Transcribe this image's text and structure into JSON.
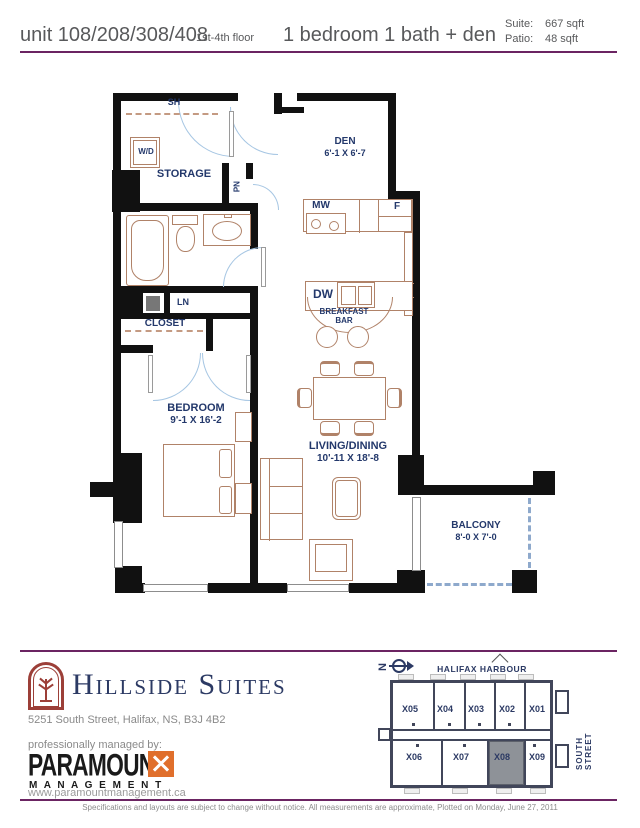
{
  "header": {
    "unit_title": "unit 108/208/308/408",
    "floor_label": "1st-4th floor",
    "unit_type": "1 bedroom 1 bath + den",
    "suite_label": "Suite:",
    "suite_value": "667 sqft",
    "patio_label": "Patio:",
    "patio_value": "48 sqft"
  },
  "floorplan": {
    "sh": "SH",
    "wd": "W/D",
    "storage": "STORAGE",
    "pn": "PN",
    "den_name": "DEN",
    "den_dims": "6'-1  X 6'-7",
    "mw": "MW",
    "f": "F",
    "dw": "DW",
    "breakfast_1": "BREAKFAST",
    "breakfast_2": "BAR",
    "ln": "LN",
    "closet": "CLOSET",
    "bedroom_name": "BEDROOM",
    "bedroom_dims": "9'-1  X 16'-2",
    "living_name": "LIVING/DINING",
    "living_dims": "10'-11  X 18'-8",
    "balcony_name": "BALCONY",
    "balcony_dims": "8'-0  X 7'-0"
  },
  "footer": {
    "property_name": "Hillside Suites",
    "address": "5251 South Street, Halifax, NS, B3J 4B2",
    "managed_by": "professionally managed by:",
    "brand": "PARAMOUNT",
    "brand_sub": "M A N A G E M E N T",
    "website": "www.paramountmanagement.ca",
    "disclaimer": "Specifications and layouts are subject to change without notice. All measurements are approximate, Plotted on Monday, June 27, 2011"
  },
  "sitemap": {
    "north": "N",
    "harbour": "HALIFAX HARBOUR",
    "street": "SOUTH STREET",
    "units_top": [
      "X05",
      "X04",
      "X03",
      "X02",
      "X01"
    ],
    "units_bottom": [
      "X06",
      "X07",
      "X08",
      "X09"
    ],
    "highlighted": "X08"
  },
  "colors": {
    "accent_purple": "#6b2462",
    "label_navy": "#23386b",
    "logo_maroon": "#9c3f38",
    "logo_orange": "#e06f2c",
    "furniture_brown": "#b08268",
    "door_arc_blue": "#a6c6e3",
    "sitemap_wall": "#41465a",
    "highlight_gray": "#8e9298",
    "header_gray": "#58595b"
  }
}
